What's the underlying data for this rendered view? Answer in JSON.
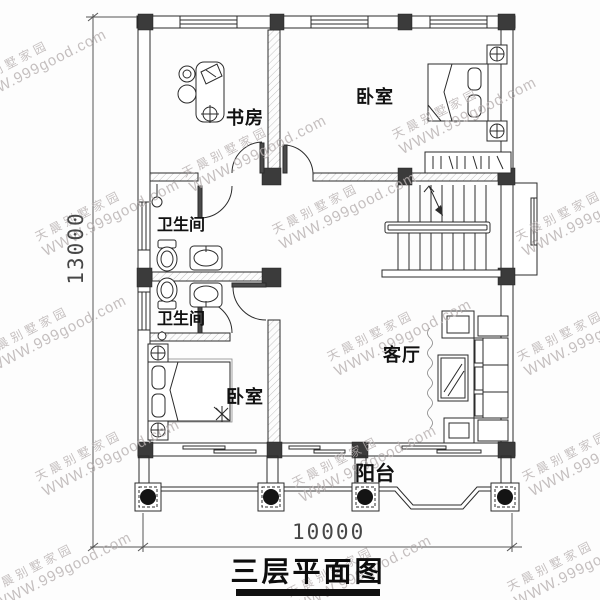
{
  "title": {
    "text": "三层平面图"
  },
  "watermark": {
    "line1": "天晨别墅家园",
    "line2": "WWW.999good.com"
  },
  "rooms": {
    "study": "书房",
    "bedroom_top": "卧室",
    "bathroom_upper": "卫生间",
    "bathroom_lower": "卫生间",
    "bedroom_bottom": "卧室",
    "living_room": "客厅",
    "balcony": "阳台"
  },
  "dimensions": {
    "total_depth": "13000",
    "total_width": "10000"
  },
  "colors": {
    "line": "#2b2b2b",
    "column_fill": "#3b3b3b",
    "watermark": "#b7b0b0",
    "title_underline": "#101010"
  }
}
